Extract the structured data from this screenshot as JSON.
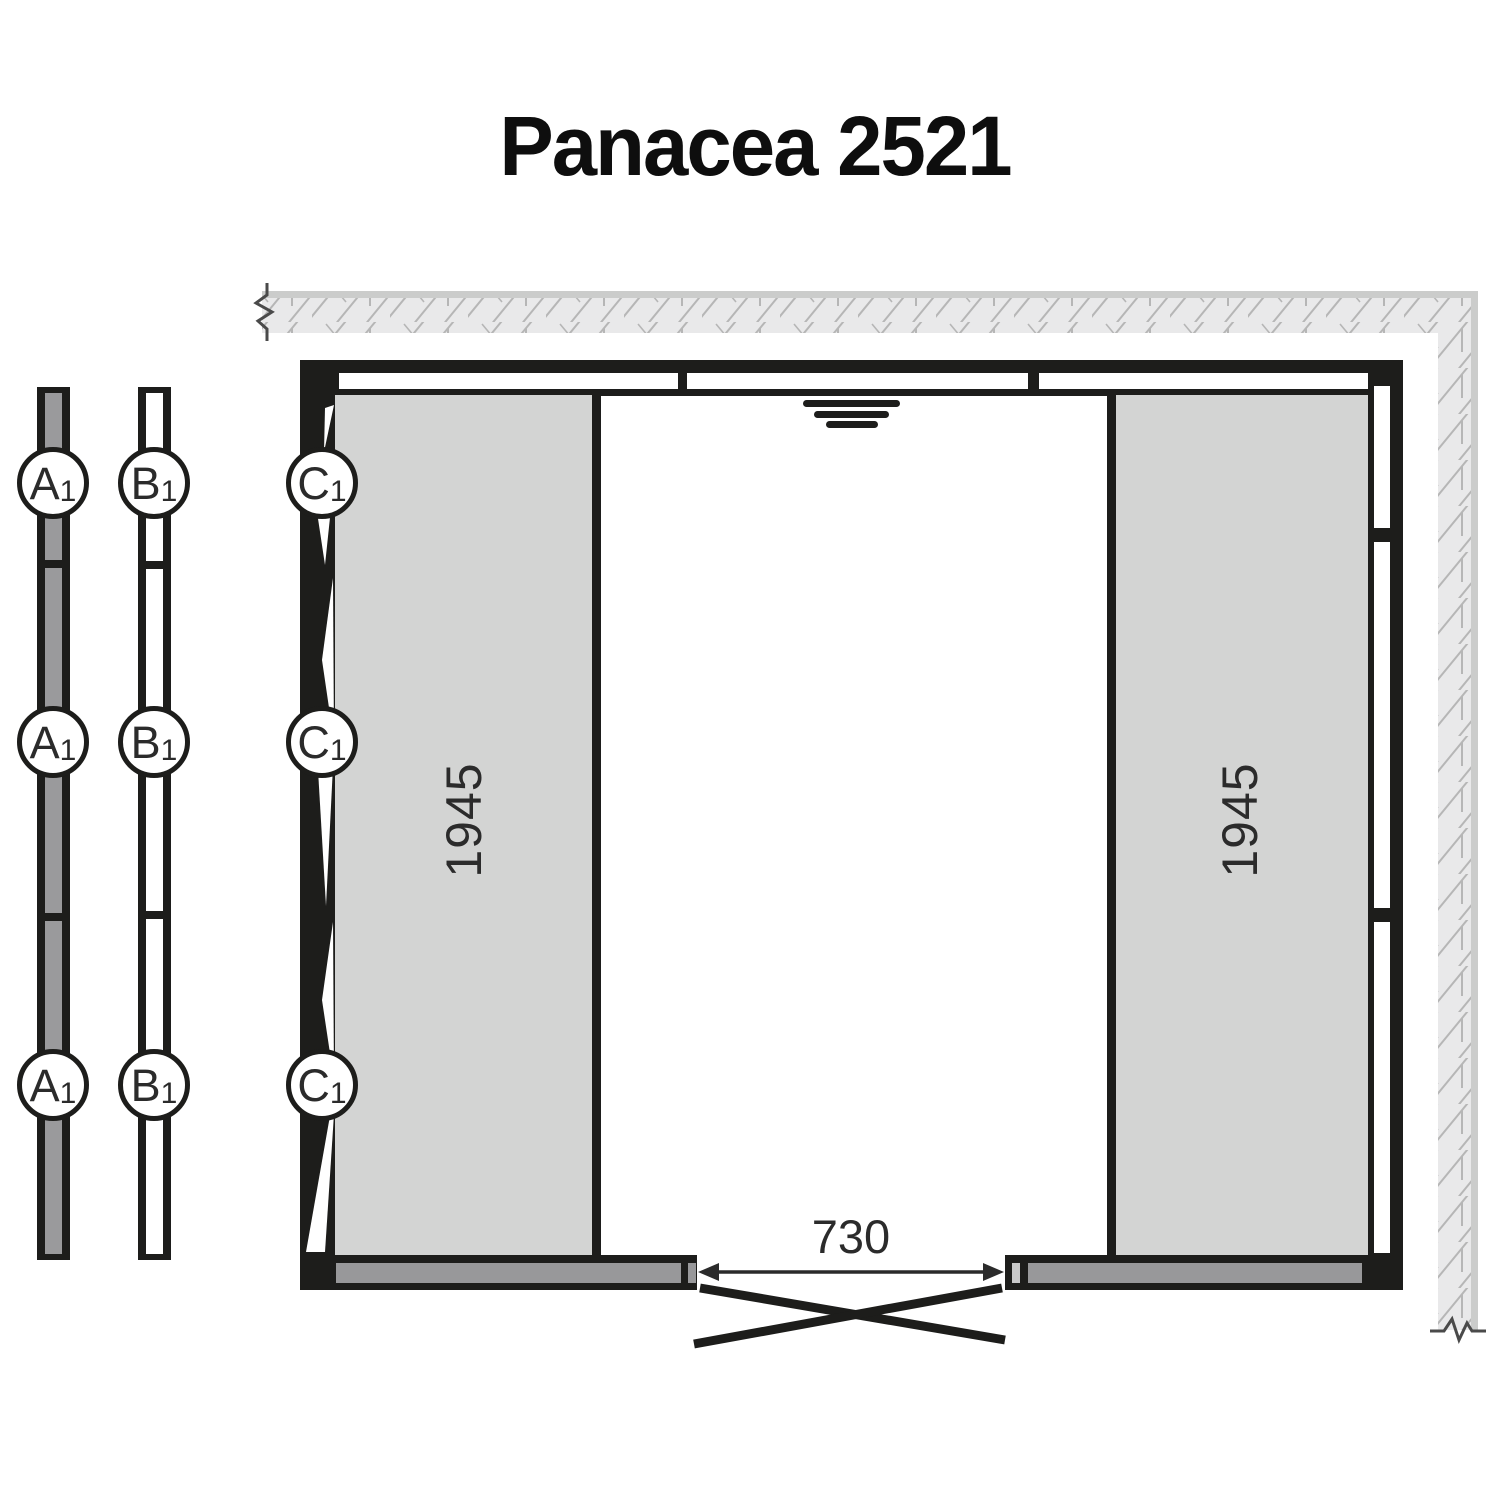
{
  "title": "Panacea 2521",
  "panel_markers": {
    "a": {
      "letter": "A",
      "sub": "1"
    },
    "b": {
      "letter": "B",
      "sub": "1"
    },
    "c": {
      "letter": "C",
      "sub": "1"
    }
  },
  "dimensions": {
    "left_panel_depth": "1945",
    "right_panel_depth": "1945",
    "door_opening_width": "730"
  },
  "colors": {
    "wall_black": "#1d1d1b",
    "interior_panel_gray": "#d3d4d3",
    "floor_beam_gray": "#98989a",
    "strip_fill_gray": "#9a9a9c",
    "existing_wall_fill": "#e9e9ea",
    "existing_wall_edge": "#cbcccb",
    "hatch_stroke": "#b6b6b6",
    "text_dark": "#2b2b2b"
  }
}
